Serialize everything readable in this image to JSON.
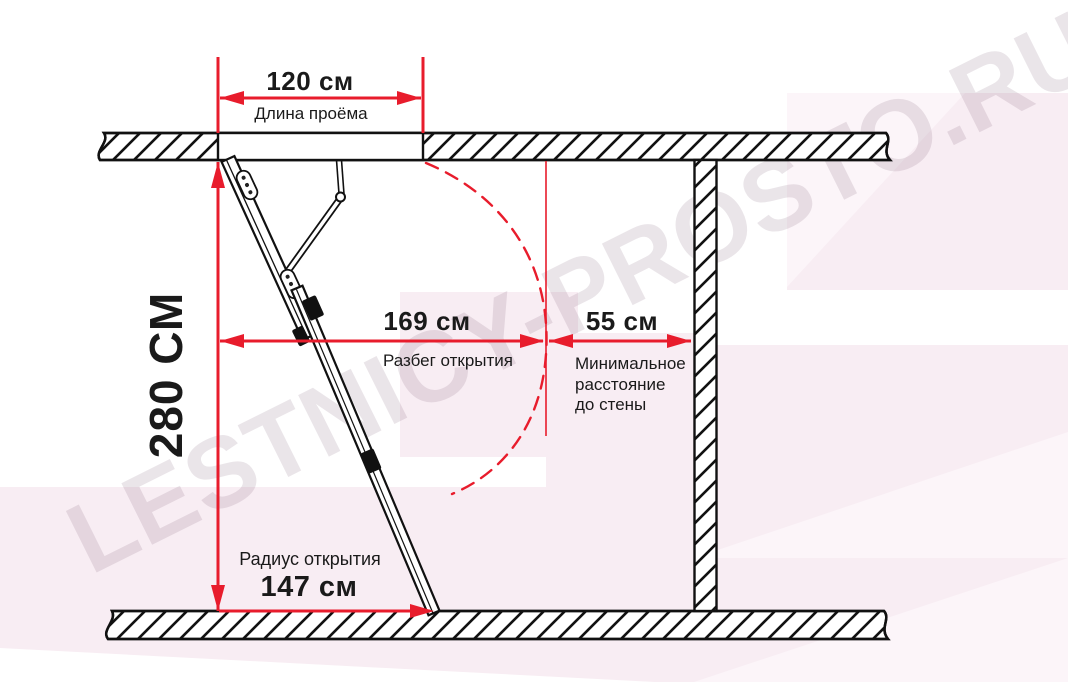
{
  "watermark": {
    "text": "LESTNICY-PROSTO.RU"
  },
  "dimensions": {
    "opening_width": {
      "value": "120 см",
      "label": "Длина проёма"
    },
    "room_height": {
      "value": "280 СМ"
    },
    "opening_run": {
      "value": "169 см",
      "label": "Разбег открытия"
    },
    "wall_clearance": {
      "value": "55 см",
      "label_lines": [
        "Минимальное",
        "расстояние",
        "до стены"
      ]
    },
    "opening_radius": {
      "value": "147 см",
      "label": "Радиус открытия"
    }
  },
  "colors": {
    "dimension_red": "#e81c2c",
    "line_black": "#111111",
    "text_black": "#1a1a1a",
    "background_pink": "#f8edf3",
    "background_pink_light": "#fcf5f9",
    "watermark_tint": "rgba(104,72,96,0.14)"
  }
}
